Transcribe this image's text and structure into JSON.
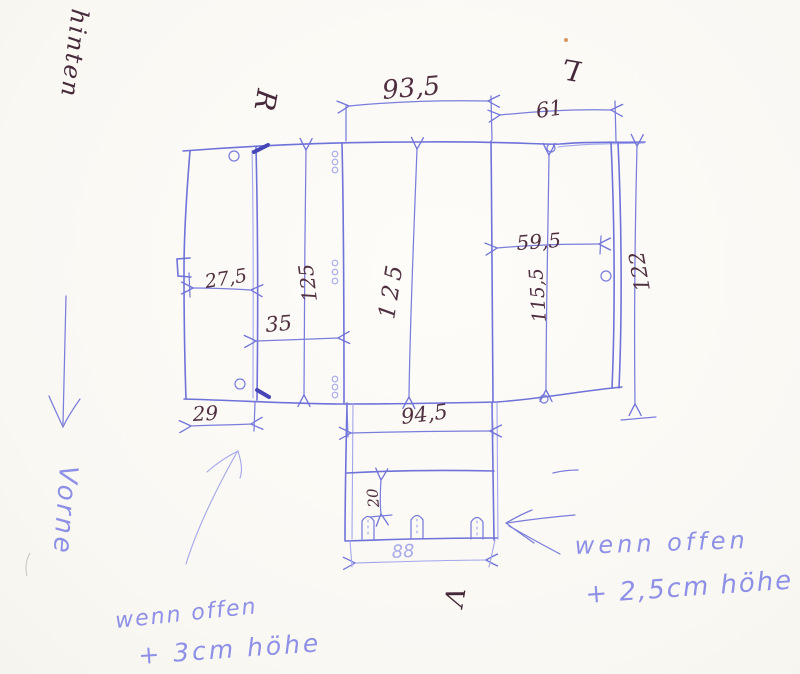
{
  "sketch_type": "hand-drawn box net with measurements",
  "colors": {
    "paper": "#fbfaf6",
    "pen_blue": "#6f72d9",
    "pen_light_blue": "#8d90e6",
    "pen_dark": "#502f40"
  },
  "labels": {
    "back": "hinten",
    "right_marker": "R",
    "left_marker": "L",
    "front_marker": "V",
    "front": "Vorne"
  },
  "dimensions": {
    "top_center_width": "93,5",
    "top_right_width": "61",
    "left_flap_width": "27,5",
    "left_panel_width": "35",
    "left_flap_bottom_width": "29",
    "left_panel_height": "125",
    "center_panel_height": "125",
    "right_panel_inner_width": "59,5",
    "right_panel_inner_height": "115,5",
    "right_panel_height": "122",
    "bottom_flap_width": "94,5",
    "bottom_flap_lip_height": "20",
    "bottom_flap_inner_width": "88"
  },
  "notes": {
    "bottom_left": {
      "line1": "wenn offen",
      "line2": "+ 3cm höhe"
    },
    "bottom_right": {
      "line1": "wenn offen",
      "line2": "+ 2,5cm höhe"
    }
  }
}
